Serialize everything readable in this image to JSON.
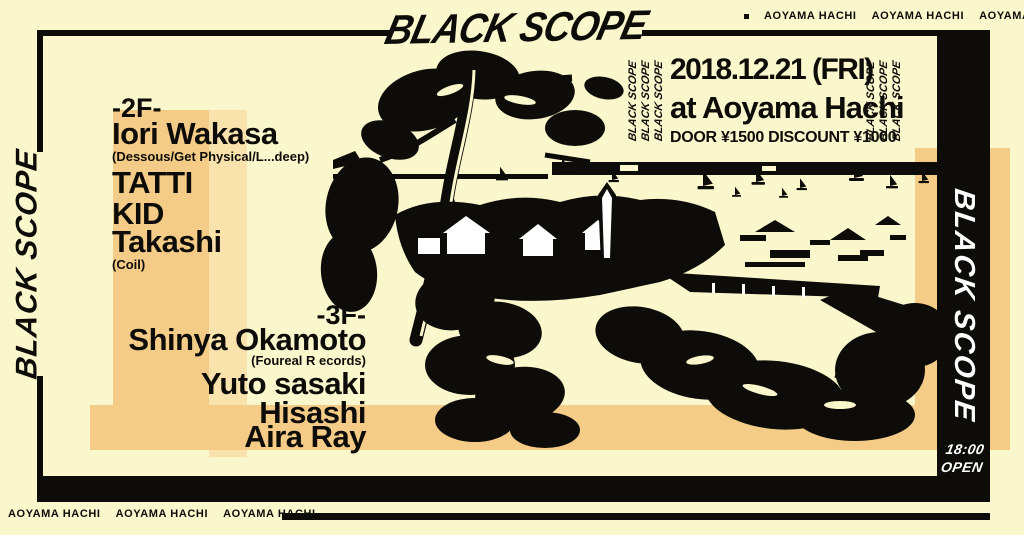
{
  "colors": {
    "bg": "#FAF7CD",
    "ink": "#0D0C08",
    "accent": "#F5CC87",
    "accent-light": "#FAE2AD",
    "paper-white": "#FFFFFF"
  },
  "branding": {
    "title": "BLACK SCOPE"
  },
  "marquee": {
    "venue": "AOYAMA HACHI"
  },
  "event": {
    "date": "2018.12.21 (FRI)",
    "venue": "at Aoyama Hachi",
    "price": "DOOR ¥1500 DISCOUNT ¥1000",
    "open_time": "18:00",
    "open_label": "OPEN"
  },
  "floors": [
    {
      "label": "-2F-",
      "artists": [
        {
          "name": "Iori Wakasa",
          "affiliation": "(Dessous/Get Physical/L...deep)"
        },
        {
          "name": "TATTI"
        },
        {
          "name": "KID"
        },
        {
          "name": "Takashi",
          "affiliation": "(Coil)"
        }
      ]
    },
    {
      "label": "-3F-",
      "artists": [
        {
          "name": "Shinya Okamoto",
          "affiliation": "(Foureal R ecords)"
        },
        {
          "name": "Yuto sasaki"
        },
        {
          "name": "Hisashi"
        },
        {
          "name": "Aira Ray"
        }
      ]
    }
  ]
}
